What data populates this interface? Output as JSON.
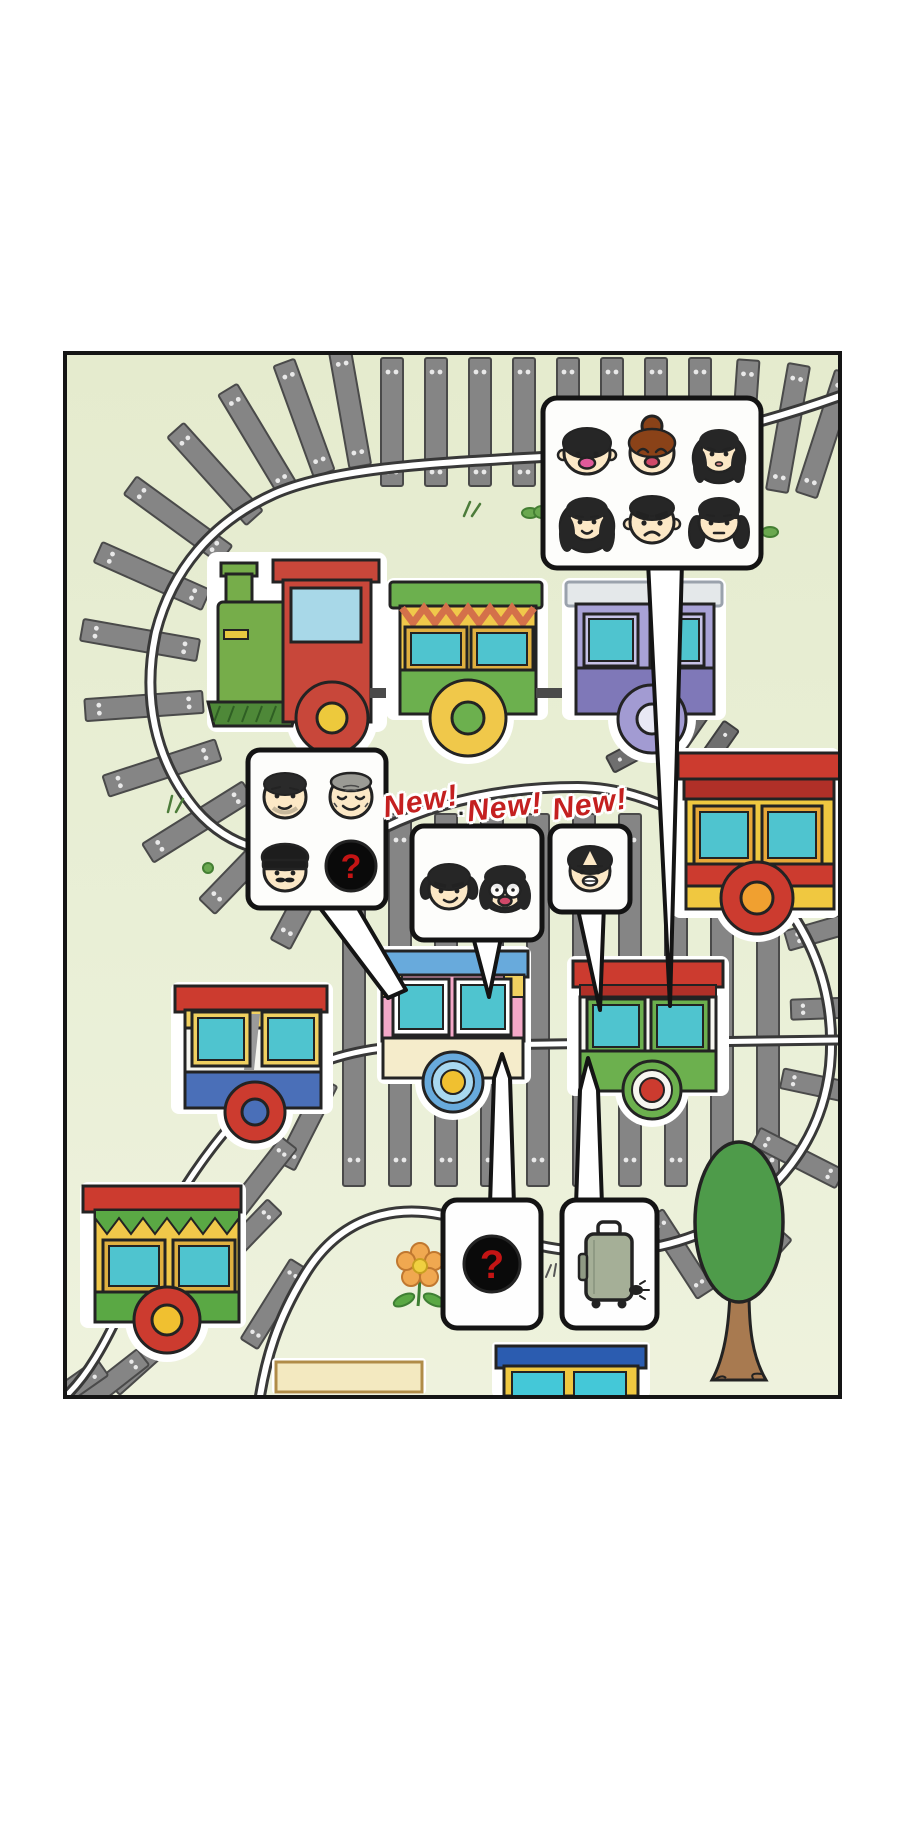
{
  "panel": {
    "background": "#e7edd2",
    "border_color": "#151515"
  },
  "labels": {
    "new_badges": [
      "New!",
      "New!",
      "New!"
    ],
    "separator_dot": "·"
  },
  "question_marks": {
    "roster_unknown": "?",
    "cargo_unknown": "?"
  },
  "speech_bubbles": [
    {
      "name": "family-roster-bubble",
      "faces": 6
    },
    {
      "name": "elder-roster-bubble",
      "faces": 3,
      "has_unknown_slot": true
    },
    {
      "name": "new-pair-bubble",
      "faces": 2
    },
    {
      "name": "new-single-bubble",
      "faces": 1
    }
  ],
  "icons": {
    "luggage": "suitcase-icon",
    "unknown": "question-mark-icon",
    "plant": "flower-icon",
    "landmark": "tree-icon"
  },
  "colors": {
    "track_tie": "#858585",
    "track_tie_border": "#4a4a4a",
    "rail_dark": "#383838",
    "engine_green": "#76ad4a",
    "engine_red": "#c8473a",
    "roof_red": "#cc3b2f",
    "yellow": "#f0c84a",
    "green": "#6cb04e",
    "teal_window": "#4fc4cf",
    "cab_window": "#a8d8e8",
    "periwinkle_body": "#a8a2d6",
    "periwinkle_dark": "#7f78b8",
    "blue_band": "#4a6fb8",
    "roof_blue": "#68aadc",
    "pink": "#f4a8c8",
    "cream": "#f5eccb",
    "new_badge_red": "#c42020",
    "qmark_red": "#c41414",
    "skin": "#fce8c6",
    "hair_black": "#262626",
    "hair_brown": "#8a4218",
    "hair_gray": "#9b9b95",
    "suitcase_gray": "#a5af97",
    "tree_green": "#4e9b4a",
    "trunk_brown": "#a87a50",
    "flower_orange": "#f0a850",
    "flower_center": "#f0d040",
    "grass_green": "#5aa844"
  }
}
